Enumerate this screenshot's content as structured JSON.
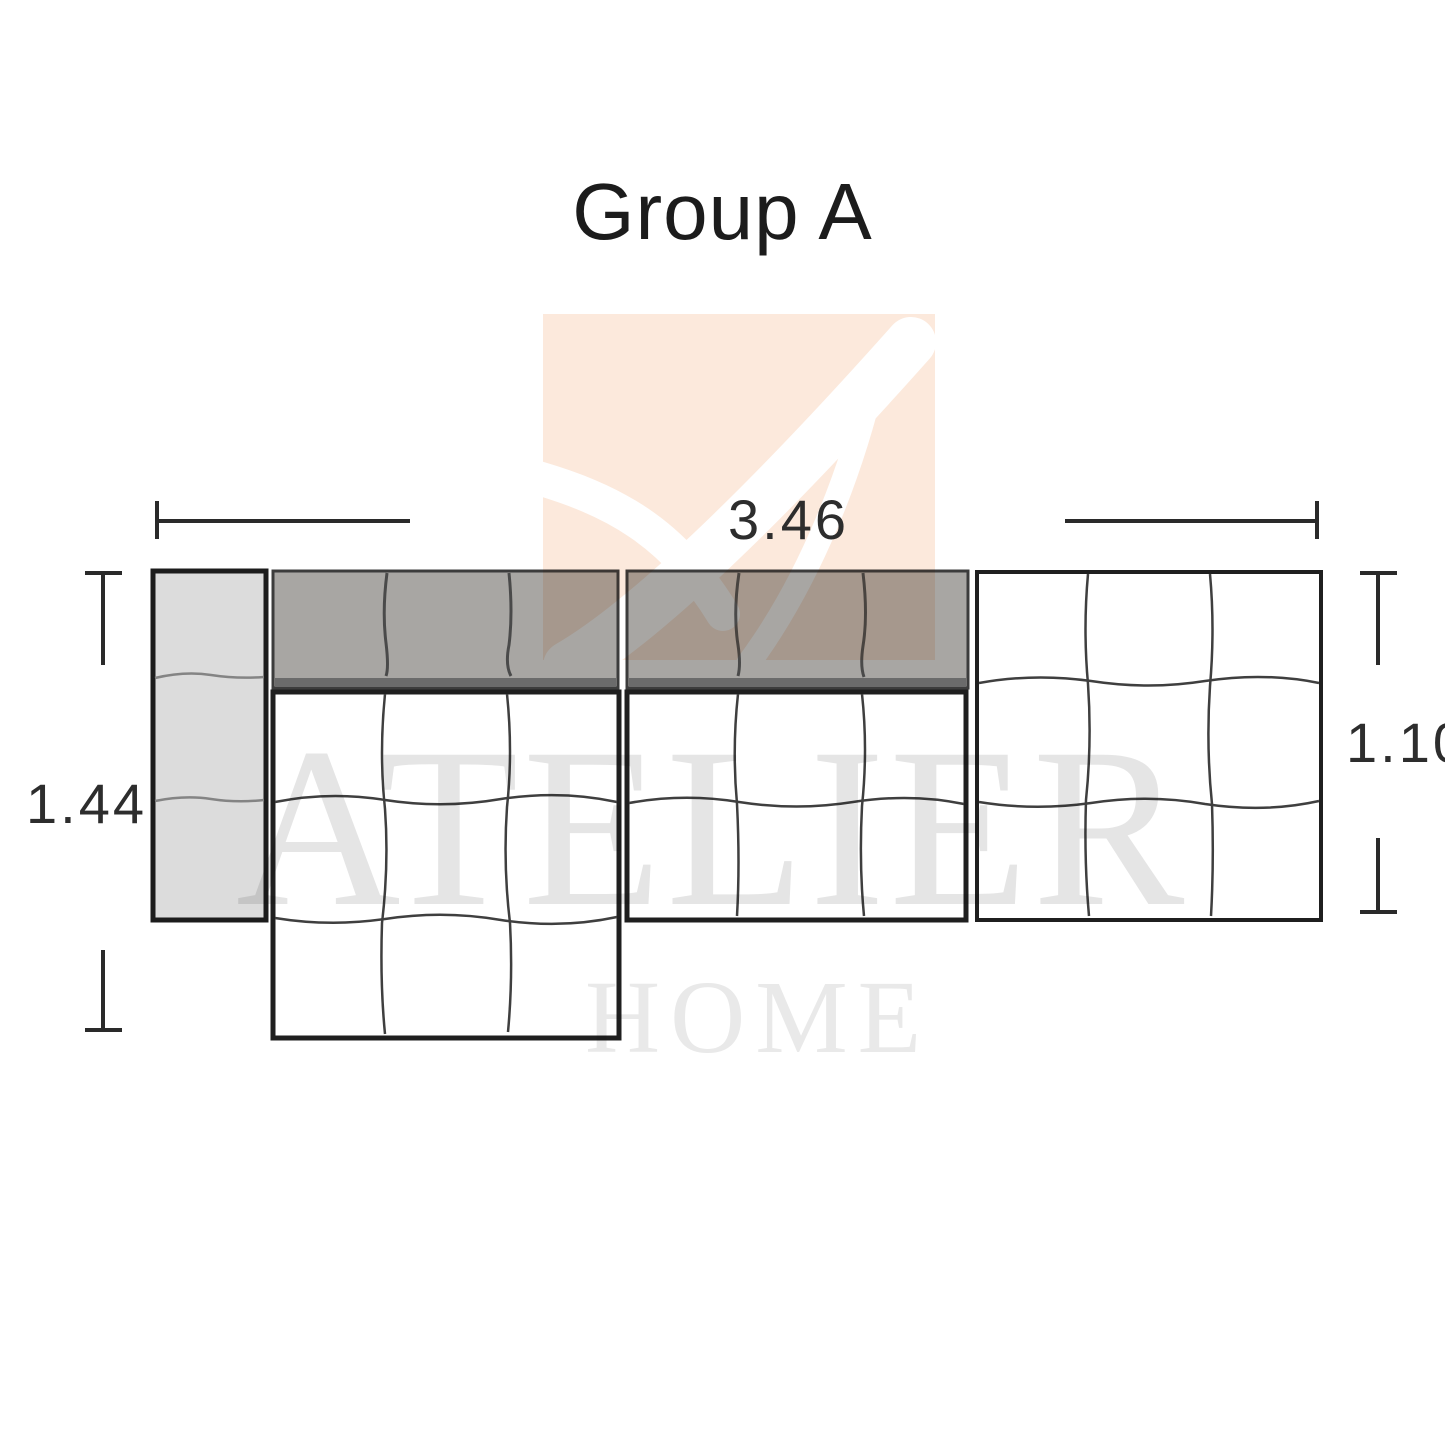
{
  "title": "Group A",
  "dimensions": {
    "width": "3.46",
    "left_depth": "1.44",
    "right_depth": "1.10"
  },
  "watermark": {
    "line1": "ATELIER",
    "line2": "HOME"
  },
  "colors": {
    "outline": "#1f1f1f",
    "backrest_gray": "#a8a6a3",
    "backrest_edge_dark": "#6b6b6b",
    "armrest_gray": "#dcdcdc",
    "grid_line": "#3f3f3f",
    "dimension_line": "#2a2a2a",
    "watermark_peach": "#fce9dc",
    "watermark_text": "#e5e5e5"
  }
}
